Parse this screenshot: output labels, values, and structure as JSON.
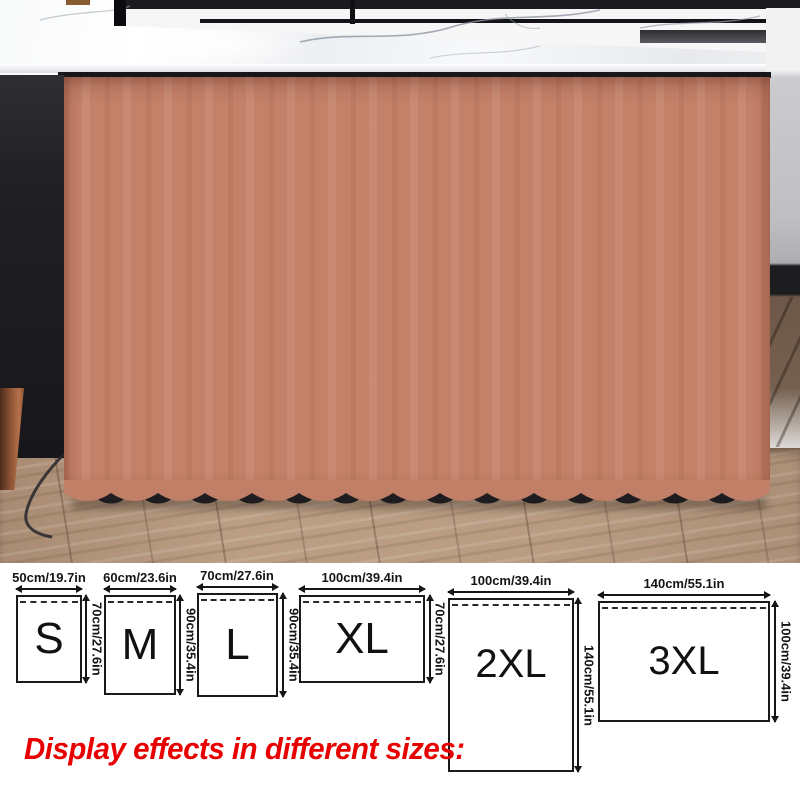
{
  "photo": {
    "scene": "terracotta curtain hung under a white marble kitchen island over a wood floor",
    "colors": {
      "curtain": "#c48169",
      "curtain_shadow": "#8f5540",
      "countertop_marble": "#f2f4f6",
      "counter_underline": "#17171a",
      "left_cabinet": "#1f1f23",
      "floor_wood": "#b2957c",
      "right_wall": "#c2c2c5",
      "baseboard": "#1d1d20",
      "top_strip": "#1b1b1f"
    }
  },
  "size_chart": {
    "sizes": [
      {
        "label": "S",
        "width_label": "50cm/19.7in",
        "height_label": "70cm/27.6in"
      },
      {
        "label": "M",
        "width_label": "60cm/23.6in",
        "height_label": "90cm/35.4in"
      },
      {
        "label": "L",
        "width_label": "70cm/27.6in",
        "height_label": "90cm/35.4in"
      },
      {
        "label": "XL",
        "width_label": "100cm/39.4in",
        "height_label": "70cm/27.6in"
      },
      {
        "label": "2XL",
        "width_label": "100cm/39.4in",
        "height_label": "140cm/55.1in"
      },
      {
        "label": "3XL",
        "width_label": "140cm/55.1in",
        "height_label": "100cm/39.4in"
      }
    ]
  },
  "caption": {
    "text": "Display effects in different sizes:",
    "color": "#e80000"
  }
}
